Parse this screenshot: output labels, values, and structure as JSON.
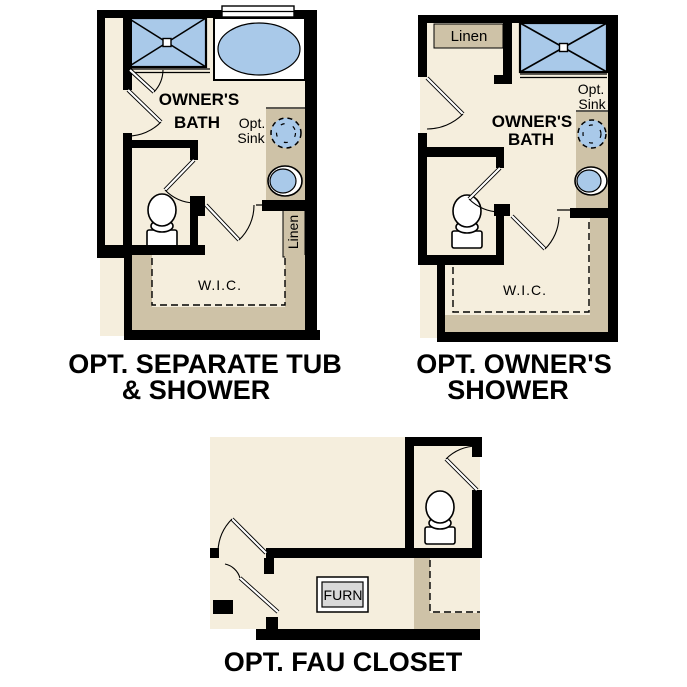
{
  "colors": {
    "background": "#ffffff",
    "floor": "#f5eedd",
    "shelf_tan": "#cec2a7",
    "fixture_blue": "#a9c9e9",
    "wall_black": "#000000",
    "furnace_gray": "#d9d9d9"
  },
  "plans": {
    "separate": {
      "caption_line1": "OPT. SEPARATE TUB",
      "caption_line2": "& SHOWER",
      "room_line1": "OWNER'S",
      "room_line2": "BATH",
      "opt_sink_line1": "Opt.",
      "opt_sink_line2": "Sink",
      "wic_label": "W.I.C.",
      "linen_label": "Linen"
    },
    "shower": {
      "caption_line1": "OPT. OWNER'S",
      "caption_line2": "SHOWER",
      "room_line1": "OWNER'S",
      "room_line2": "BATH",
      "opt_sink_line1": "Opt.",
      "opt_sink_line2": "Sink",
      "wic_label": "W.I.C.",
      "linen_label": "Linen"
    },
    "fau": {
      "caption": "OPT. FAU CLOSET",
      "furnace_label": "FURN"
    }
  }
}
